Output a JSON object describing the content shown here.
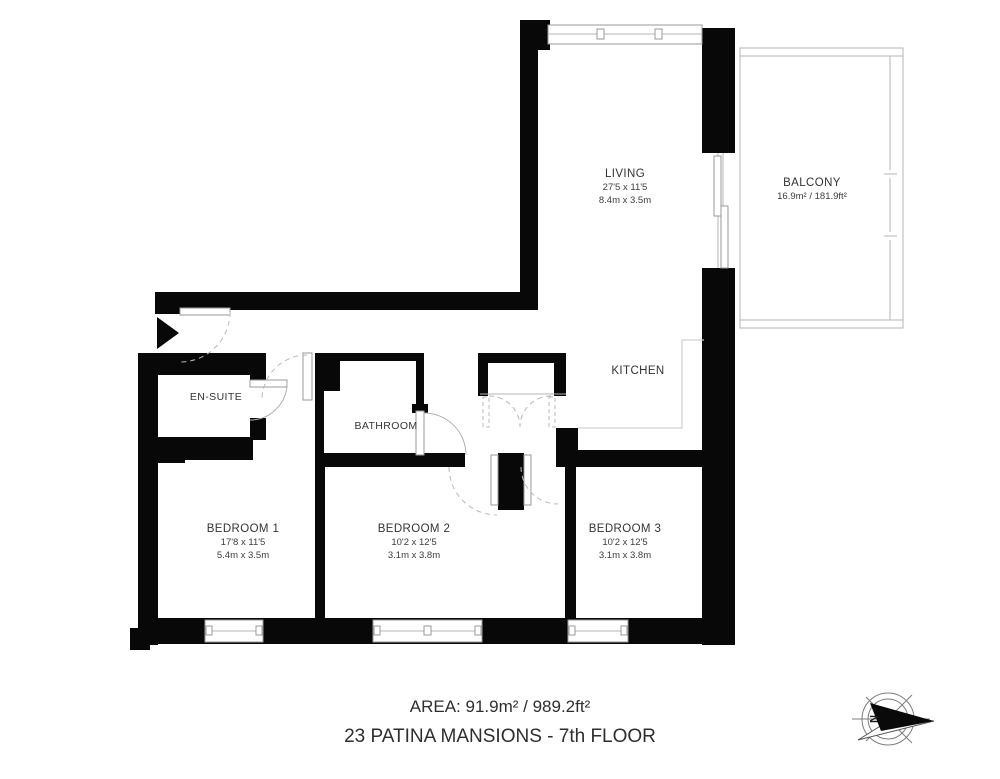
{
  "rooms": {
    "living": {
      "name": "LIVING",
      "dim_imperial": "27'5 x 11'5",
      "dim_metric": "8.4m x 3.5m"
    },
    "balcony": {
      "name": "BALCONY",
      "area": "16.9m² / 181.9ft²"
    },
    "kitchen": {
      "name": "KITCHEN"
    },
    "ensuite": {
      "name": "EN-SUITE"
    },
    "bathroom": {
      "name": "BATHROOM"
    },
    "bedroom1": {
      "name": "BEDROOM 1",
      "dim_imperial": "17'8 x 11'5",
      "dim_metric": "5.4m x 3.5m"
    },
    "bedroom2": {
      "name": "BEDROOM 2",
      "dim_imperial": "10'2 x 12'5",
      "dim_metric": "3.1m x 3.8m"
    },
    "bedroom3": {
      "name": "BEDROOM 3",
      "dim_imperial": "10'2 x 12'5",
      "dim_metric": "3.1m x 3.8m"
    }
  },
  "footer": {
    "area_line": "AREA: 91.9m² / 989.2ft²",
    "title_line": "23 PATINA MANSIONS - 7th FLOOR"
  },
  "compass": {
    "north_label": "N"
  },
  "colors": {
    "wall": "#080808",
    "line": "#b5b5b5",
    "text": "#343434"
  }
}
